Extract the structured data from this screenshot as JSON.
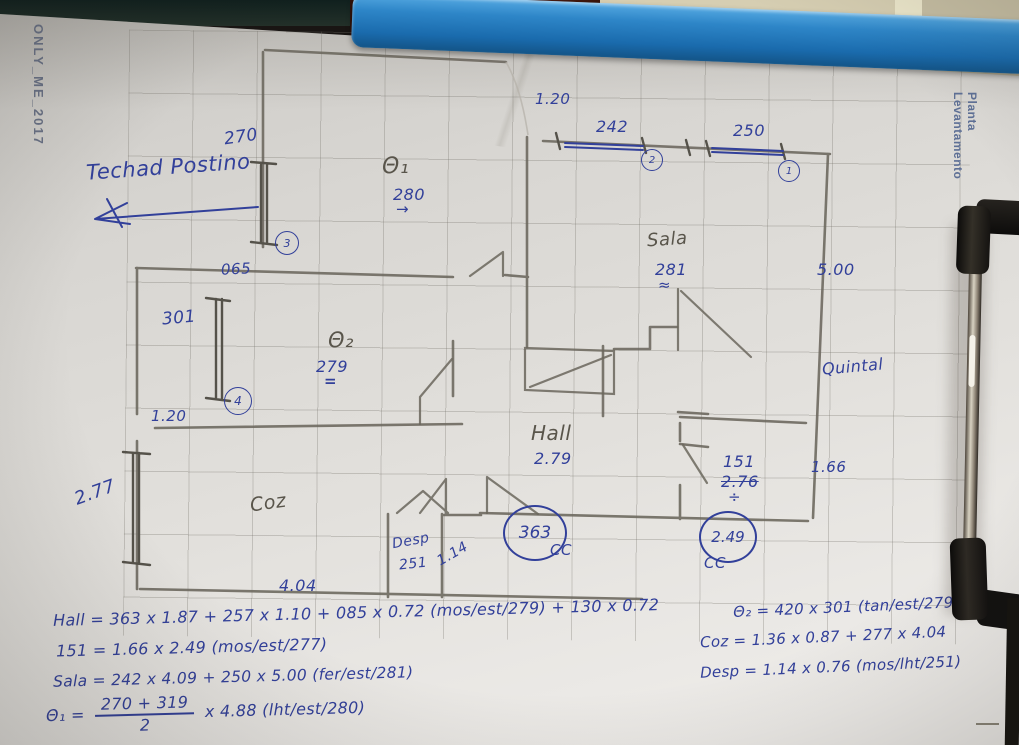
{
  "colors": {
    "ink": "#32409a",
    "pencil": "#6b675d",
    "clipboard_band": "#1f74b8"
  },
  "watermark": "ONLY_ME_2017",
  "side_label": "Planta Levantamento",
  "note": "Techad Postino",
  "plan": {
    "top_width": "4.70",
    "upper_gap": "1.20",
    "win242": "242",
    "win250": "250",
    "win270": "270",
    "markers": {
      "m1": "1",
      "m2": "2",
      "m3": "3",
      "m4": "4"
    },
    "q1": {
      "name": "Θ₁",
      "height": "280",
      "arrow": "→"
    },
    "q2": {
      "name": "Θ₂",
      "height": "279",
      "mark": "="
    },
    "sala": {
      "name": "Sala",
      "height": "281",
      "mark": "≈"
    },
    "hall": {
      "name": "Hall",
      "height": "2.79"
    },
    "coz": {
      "name": "Coz"
    },
    "room151": {
      "name": "151",
      "height": "2.76",
      "mark": "÷"
    },
    "desp": {
      "name": "Desp",
      "height": "251"
    },
    "quintal": "Quintal",
    "d065": "065",
    "d301": "301",
    "d120": "1.20",
    "d277": "2.77",
    "d500": "5.00",
    "d166": "1.66",
    "d114": "1.14",
    "d404": "4.04",
    "door363": "363",
    "door249": "2.49",
    "cc": "CC"
  },
  "formulas": {
    "hall": "Hall = 363 x 1.87 + 257 x 1.10 + 085 x 0.72 (mos/est/279) + 130 x 0.72",
    "f151": "151 = 1.66 x 2.49 (mos/est/277)",
    "sala": "Sala = 242 x 4.09 + 250 x 5.00 (fer/est/281)",
    "q1_lhs": "Θ₁ =",
    "q1_num": "270 + 319",
    "q1_den": "2",
    "q1_rhs": "x 4.88 (lht/est/280)",
    "q2": "Θ₂ = 420 x 301 (tan/est/279)",
    "coz": "Coz = 1.36 x 0.87 + 277 x 4.04",
    "desp": "Desp = 1.14 x 0.76 (mos/lht/251)"
  }
}
